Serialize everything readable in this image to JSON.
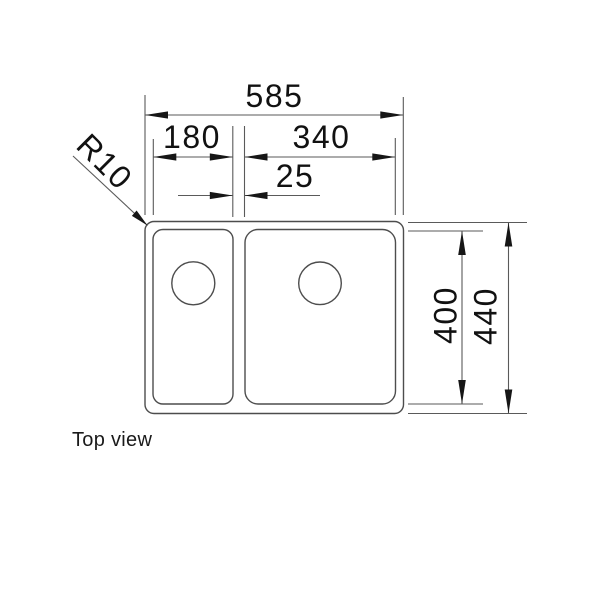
{
  "drawing": {
    "type": "technical-dimension-drawing",
    "subject": "double-bowl sink top view",
    "caption": "Top view",
    "dimensions": {
      "overall_width": "585",
      "left_bowl_width": "180",
      "right_bowl_width": "340",
      "divider_gap": "25",
      "corner_radius": "R10",
      "bowl_depth": "400",
      "overall_depth": "440"
    },
    "colors": {
      "background": "#ffffff",
      "outline": "#4d4d4d",
      "dimension_line": "#5a5a5a",
      "text": "#111111",
      "arrow": "#161616"
    }
  }
}
